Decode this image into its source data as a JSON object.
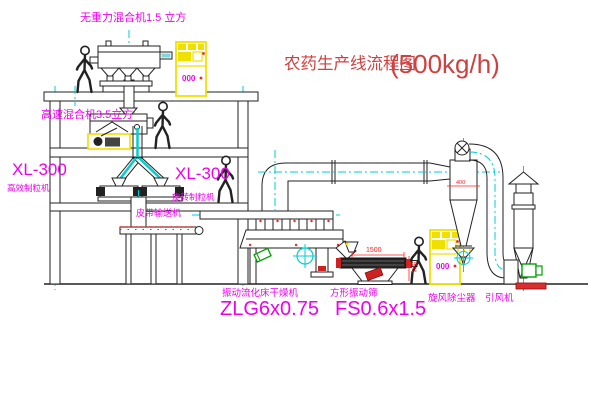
{
  "title": {
    "text": "农药生产线流程图",
    "capacity": "(500kg/h)"
  },
  "labels": {
    "mixer_top": "无重力混合机1.5 立方",
    "mixer_mid": "高速混合机3.5立方",
    "granulator_left_model": "XL-300",
    "granulator_left_name": "高效制粒机",
    "granulator_right_model": "XL-300",
    "granulator_right_name": "旋转制粒机",
    "belt_conveyor": "皮带输送机",
    "dryer_name": "振动流化床干燥机",
    "dryer_model": "ZLG6x0.75",
    "screen_name": "方形振动筛",
    "screen_model": "FS0.6x1.5",
    "cyclone_name": "旋风除尘器",
    "fan_name": "引风机"
  },
  "dimensions": {
    "screen_length": "1500",
    "screen_height": "541",
    "cyclone_inlet": "400"
  },
  "cabinets": [
    {
      "display_text": "000"
    },
    {
      "display_text": "000"
    }
  ],
  "colors": {
    "title_red": "#d04040",
    "label_magenta": "#ee00ee",
    "dimension_red": "#ff2020",
    "centerline_cyan": "#00cfcf",
    "highlight_yellow": "#f0e000",
    "line_black": "#222222",
    "background": "#ffffff"
  }
}
